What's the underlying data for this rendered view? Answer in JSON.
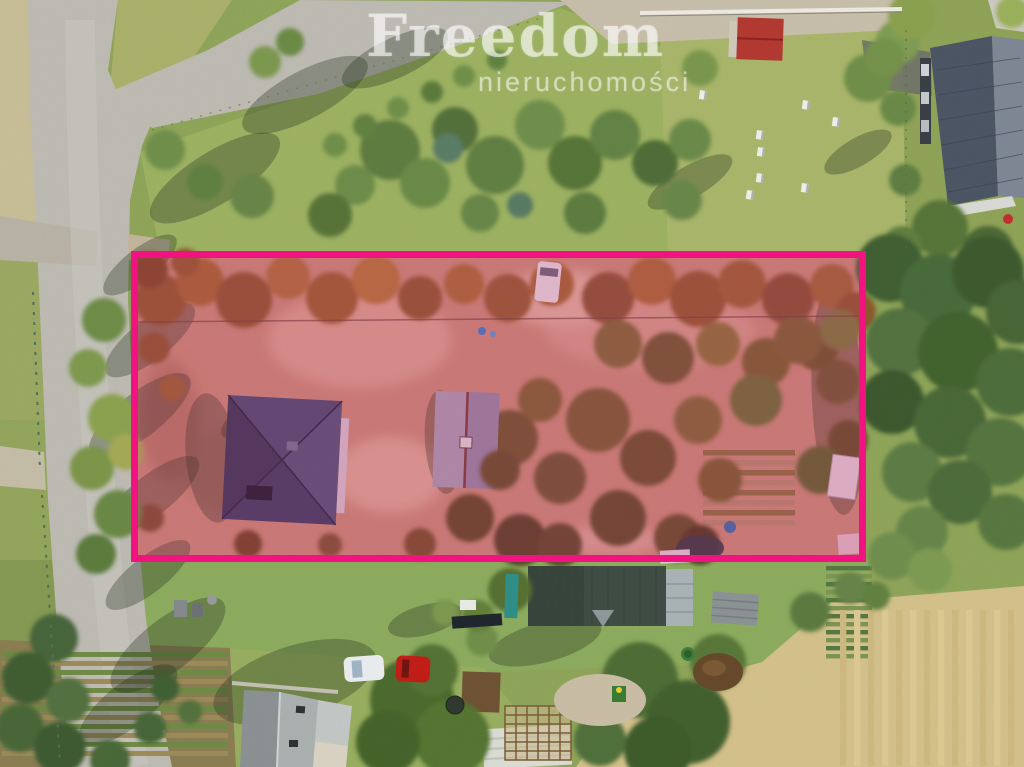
{
  "watermark": {
    "brand": "Freedom",
    "subtitle": "nieruchomości",
    "brand_color": "rgba(255,255,255,0.55)",
    "subtitle_color": "rgba(255,255,255,0.5)"
  },
  "boundary": {
    "label": "highlighted-property-plot",
    "left": 131,
    "top": 251,
    "width": 735,
    "height": 311,
    "border_width": 7,
    "color": "#f01380",
    "fill_tint": "rgba(236,24,128,0.16)"
  },
  "scene": {
    "shadow_color": "rgba(35,52,30,0.33)",
    "green_trees": [
      [
        390,
        150,
        30,
        "#5e7c40"
      ],
      [
        425,
        183,
        25,
        "#6b8a47"
      ],
      [
        455,
        130,
        23,
        "#52703a"
      ],
      [
        495,
        165,
        29,
        "#617f43"
      ],
      [
        540,
        125,
        25,
        "#6f8e4c"
      ],
      [
        575,
        163,
        27,
        "#567439"
      ],
      [
        615,
        135,
        25,
        "#638245"
      ],
      [
        655,
        163,
        23,
        "#4f6d38"
      ],
      [
        690,
        140,
        21,
        "#6b8a48"
      ],
      [
        585,
        213,
        21,
        "#5d7c40"
      ],
      [
        480,
        213,
        19,
        "#688646"
      ],
      [
        448,
        148,
        15,
        "#5a7d66"
      ],
      [
        520,
        205,
        13,
        "#587a64"
      ],
      [
        355,
        185,
        20,
        "#6d8c4a"
      ],
      [
        330,
        215,
        22,
        "#597338"
      ],
      [
        335,
        145,
        12,
        "#6f8f4a"
      ],
      [
        365,
        126,
        12,
        "#62813f"
      ],
      [
        398,
        108,
        11,
        "#6f8f4a"
      ],
      [
        432,
        92,
        11,
        "#5c7a3b"
      ],
      [
        464,
        76,
        11,
        "#6f8f4a"
      ],
      [
        497,
        60,
        10,
        "#62813f"
      ],
      [
        165,
        150,
        20,
        "#6f8f4c"
      ],
      [
        205,
        182,
        18,
        "#5f8040"
      ],
      [
        252,
        196,
        22,
        "#688447"
      ],
      [
        290,
        42,
        14,
        "#6b8a45"
      ],
      [
        265,
        62,
        16,
        "#7b9850"
      ],
      [
        700,
        68,
        18,
        "#7a964e"
      ],
      [
        868,
        78,
        24,
        "#708e48"
      ],
      [
        898,
        42,
        22,
        "#7f9b52"
      ],
      [
        682,
        200,
        20,
        "#69874a"
      ],
      [
        905,
        180,
        16,
        "#5f7e42"
      ],
      [
        912,
        16,
        24,
        "#8aa04f"
      ],
      [
        884,
        58,
        20,
        "#75924b"
      ],
      [
        898,
        108,
        18,
        "#6b8947"
      ],
      [
        1012,
        12,
        16,
        "#9ab05a"
      ],
      [
        940,
        228,
        28,
        "#567439"
      ],
      [
        988,
        252,
        26,
        "#4b6836"
      ],
      [
        1014,
        300,
        24,
        "#476434"
      ],
      [
        902,
        246,
        20,
        "#5f7e41"
      ],
      [
        890,
        268,
        34,
        "#415f32"
      ],
      [
        938,
        292,
        38,
        "#4a6a3a"
      ],
      [
        988,
        272,
        36,
        "#3d5a2f"
      ],
      [
        1018,
        312,
        32,
        "#466536"
      ],
      [
        900,
        342,
        34,
        "#527240"
      ],
      [
        958,
        352,
        40,
        "#43622f"
      ],
      [
        1010,
        382,
        34,
        "#4e6d3b"
      ],
      [
        892,
        402,
        32,
        "#3c592e"
      ],
      [
        950,
        422,
        36,
        "#486737"
      ],
      [
        1000,
        452,
        34,
        "#55743f"
      ],
      [
        912,
        472,
        30,
        "#5d7c44"
      ],
      [
        960,
        492,
        32,
        "#4d6c3a"
      ],
      [
        1006,
        522,
        28,
        "#587741"
      ],
      [
        922,
        532,
        26,
        "#668549"
      ],
      [
        892,
        556,
        24,
        "#6f8e4d"
      ],
      [
        930,
        570,
        22,
        "#7d9a52"
      ],
      [
        104,
        320,
        22,
        "#6e8c47"
      ],
      [
        88,
        368,
        19,
        "#7e994e"
      ],
      [
        112,
        418,
        24,
        "#8ba14f"
      ],
      [
        92,
        468,
        22,
        "#7b9549"
      ],
      [
        118,
        514,
        24,
        "#6a8845"
      ],
      [
        96,
        554,
        20,
        "#5c7b3e"
      ],
      [
        126,
        452,
        18,
        "#a3a955"
      ],
      [
        54,
        638,
        24,
        "#47653a"
      ],
      [
        28,
        678,
        26,
        "#3f5d33"
      ],
      [
        68,
        700,
        22,
        "#527141"
      ],
      [
        20,
        728,
        24,
        "#486639"
      ],
      [
        60,
        748,
        26,
        "#3c5a30"
      ],
      [
        110,
        760,
        20,
        "#4a6838"
      ],
      [
        482,
        640,
        16,
        "#6f8e4a"
      ],
      [
        445,
        612,
        13,
        "#7d984f"
      ],
      [
        510,
        590,
        22,
        "#566f31"
      ],
      [
        478,
        616,
        16,
        "#647f3a"
      ],
      [
        810,
        612,
        20,
        "#5b7a40"
      ],
      [
        850,
        588,
        16,
        "#688349"
      ],
      [
        876,
        596,
        14,
        "#62813f"
      ],
      [
        412,
        700,
        42,
        "#4c6b2e"
      ],
      [
        452,
        738,
        38,
        "#557432"
      ],
      [
        388,
        742,
        32,
        "#45642c"
      ],
      [
        432,
        670,
        26,
        "#547236"
      ],
      [
        640,
        680,
        38,
        "#4e6d35"
      ],
      [
        688,
        722,
        42,
        "#42612e"
      ],
      [
        718,
        662,
        28,
        "#587739"
      ],
      [
        658,
        750,
        34,
        "#3d5c2b"
      ],
      [
        600,
        740,
        26,
        "#50703a"
      ],
      [
        165,
        688,
        14,
        "#3f5e33"
      ],
      [
        150,
        728,
        16,
        "#476639"
      ],
      [
        190,
        712,
        12,
        "#52713d"
      ]
    ],
    "autumn_trees": [
      [
        160,
        300,
        26,
        "#8d5c2f"
      ],
      [
        200,
        282,
        24,
        "#a06832"
      ],
      [
        244,
        300,
        28,
        "#8a5a2d"
      ],
      [
        288,
        277,
        22,
        "#a9713a"
      ],
      [
        332,
        298,
        26,
        "#96622f"
      ],
      [
        376,
        280,
        24,
        "#ad7638"
      ],
      [
        420,
        298,
        22,
        "#8a5c2e"
      ],
      [
        464,
        284,
        20,
        "#a36d36"
      ],
      [
        508,
        298,
        24,
        "#905e30"
      ],
      [
        552,
        284,
        22,
        "#9c6833"
      ],
      [
        608,
        298,
        26,
        "#855831"
      ],
      [
        652,
        281,
        24,
        "#a26b34"
      ],
      [
        698,
        299,
        28,
        "#8d5c2e"
      ],
      [
        742,
        284,
        24,
        "#976433"
      ],
      [
        788,
        299,
        26,
        "#835430"
      ],
      [
        832,
        286,
        22,
        "#9a6734"
      ],
      [
        856,
        312,
        20,
        "#8a5a2e"
      ],
      [
        150,
        270,
        18,
        "#7a4e28"
      ],
      [
        185,
        262,
        14,
        "#8f5c2e"
      ],
      [
        618,
        344,
        24,
        "#7c6a36"
      ],
      [
        668,
        358,
        26,
        "#6d5c2e"
      ],
      [
        718,
        344,
        22,
        "#877338"
      ],
      [
        766,
        362,
        24,
        "#75632f"
      ],
      [
        816,
        348,
        22,
        "#6b5a2c"
      ],
      [
        840,
        330,
        20,
        "#7a7a3c"
      ],
      [
        598,
        420,
        32,
        "#746032"
      ],
      [
        648,
        458,
        28,
        "#67552c"
      ],
      [
        698,
        420,
        24,
        "#7e6a36"
      ],
      [
        618,
        518,
        28,
        "#5f4f2a"
      ],
      [
        560,
        478,
        26,
        "#6b5930"
      ],
      [
        678,
        538,
        24,
        "#64532c"
      ],
      [
        838,
        382,
        22,
        "#6e5c30"
      ],
      [
        798,
        340,
        24,
        "#796533"
      ],
      [
        848,
        440,
        20,
        "#63522b"
      ],
      [
        756,
        400,
        26,
        "#6b7034"
      ],
      [
        820,
        470,
        24,
        "#5f662f"
      ],
      [
        720,
        480,
        22,
        "#77612f"
      ],
      [
        510,
        438,
        28,
        "#6c5a2e"
      ],
      [
        540,
        400,
        22,
        "#7a6532"
      ],
      [
        154,
        348,
        16,
        "#8a5a2e"
      ],
      [
        172,
        388,
        13,
        "#956332"
      ],
      [
        150,
        518,
        14,
        "#7b5230"
      ],
      [
        248,
        544,
        14,
        "#6d4a28"
      ],
      [
        420,
        544,
        16,
        "#75522c"
      ],
      [
        330,
        545,
        12,
        "#7a5730"
      ]
    ],
    "autumn_trees_over": [
      [
        470,
        518,
        24,
        "#5d4d28"
      ],
      [
        520,
        540,
        26,
        "#554627"
      ],
      [
        560,
        545,
        22,
        "#5e4d29"
      ],
      [
        500,
        470,
        20,
        "#64522a"
      ],
      [
        700,
        545,
        20,
        "#4f3f22"
      ]
    ],
    "beehives": [
      [
        700,
        90
      ],
      [
        803,
        100
      ],
      [
        833,
        117
      ],
      [
        757,
        130
      ],
      [
        758,
        147
      ],
      [
        757,
        173
      ],
      [
        747,
        190
      ],
      [
        802,
        183
      ]
    ],
    "row_strips": [
      {
        "x": 2,
        "y": 652,
        "w": 226,
        "h": 112,
        "step": 9,
        "dir": "h",
        "c1": "#6f8a45",
        "c2": "#9c8a58"
      },
      {
        "x": 826,
        "y": 566,
        "w": 46,
        "h": 100,
        "step": 8,
        "dir": "h",
        "c1": "#567740",
        "c2": "#7d9452"
      },
      {
        "x": 703,
        "y": 450,
        "w": 92,
        "h": 86,
        "step": 10,
        "dir": "h",
        "c1": "#8a7040",
        "c2": "#b08a6a"
      },
      {
        "x": 840,
        "y": 610,
        "w": 184,
        "h": 156,
        "step": 14,
        "dir": "v",
        "c1": "#cdb87f",
        "c2": "#dcc892"
      }
    ],
    "shadows": [
      [
        150,
        340,
        55,
        20,
        -38
      ],
      [
        140,
        415,
        62,
        22,
        -38
      ],
      [
        152,
        495,
        58,
        20,
        -38
      ],
      [
        148,
        575,
        52,
        18,
        -38
      ],
      [
        168,
        645,
        70,
        26,
        -38
      ],
      [
        140,
        265,
        45,
        16,
        -38
      ],
      [
        215,
        178,
        75,
        26,
        -32
      ],
      [
        305,
        95,
        70,
        24,
        -28
      ],
      [
        395,
        58,
        58,
        20,
        -25
      ],
      [
        128,
        705,
        60,
        22,
        -38
      ],
      [
        295,
        682,
        85,
        36,
        -18
      ],
      [
        545,
        642,
        58,
        20,
        -15
      ],
      [
        425,
        620,
        38,
        15,
        -15
      ],
      [
        212,
        458,
        26,
        65,
        -6
      ],
      [
        443,
        442,
        18,
        52,
        -4
      ],
      [
        838,
        400,
        26,
        115,
        -3
      ],
      [
        690,
        182,
        48,
        16,
        -30
      ],
      [
        858,
        152,
        38,
        14,
        -30
      ],
      [
        248,
        420,
        30,
        14,
        -30
      ],
      [
        250,
        500,
        28,
        12,
        -30
      ]
    ]
  }
}
